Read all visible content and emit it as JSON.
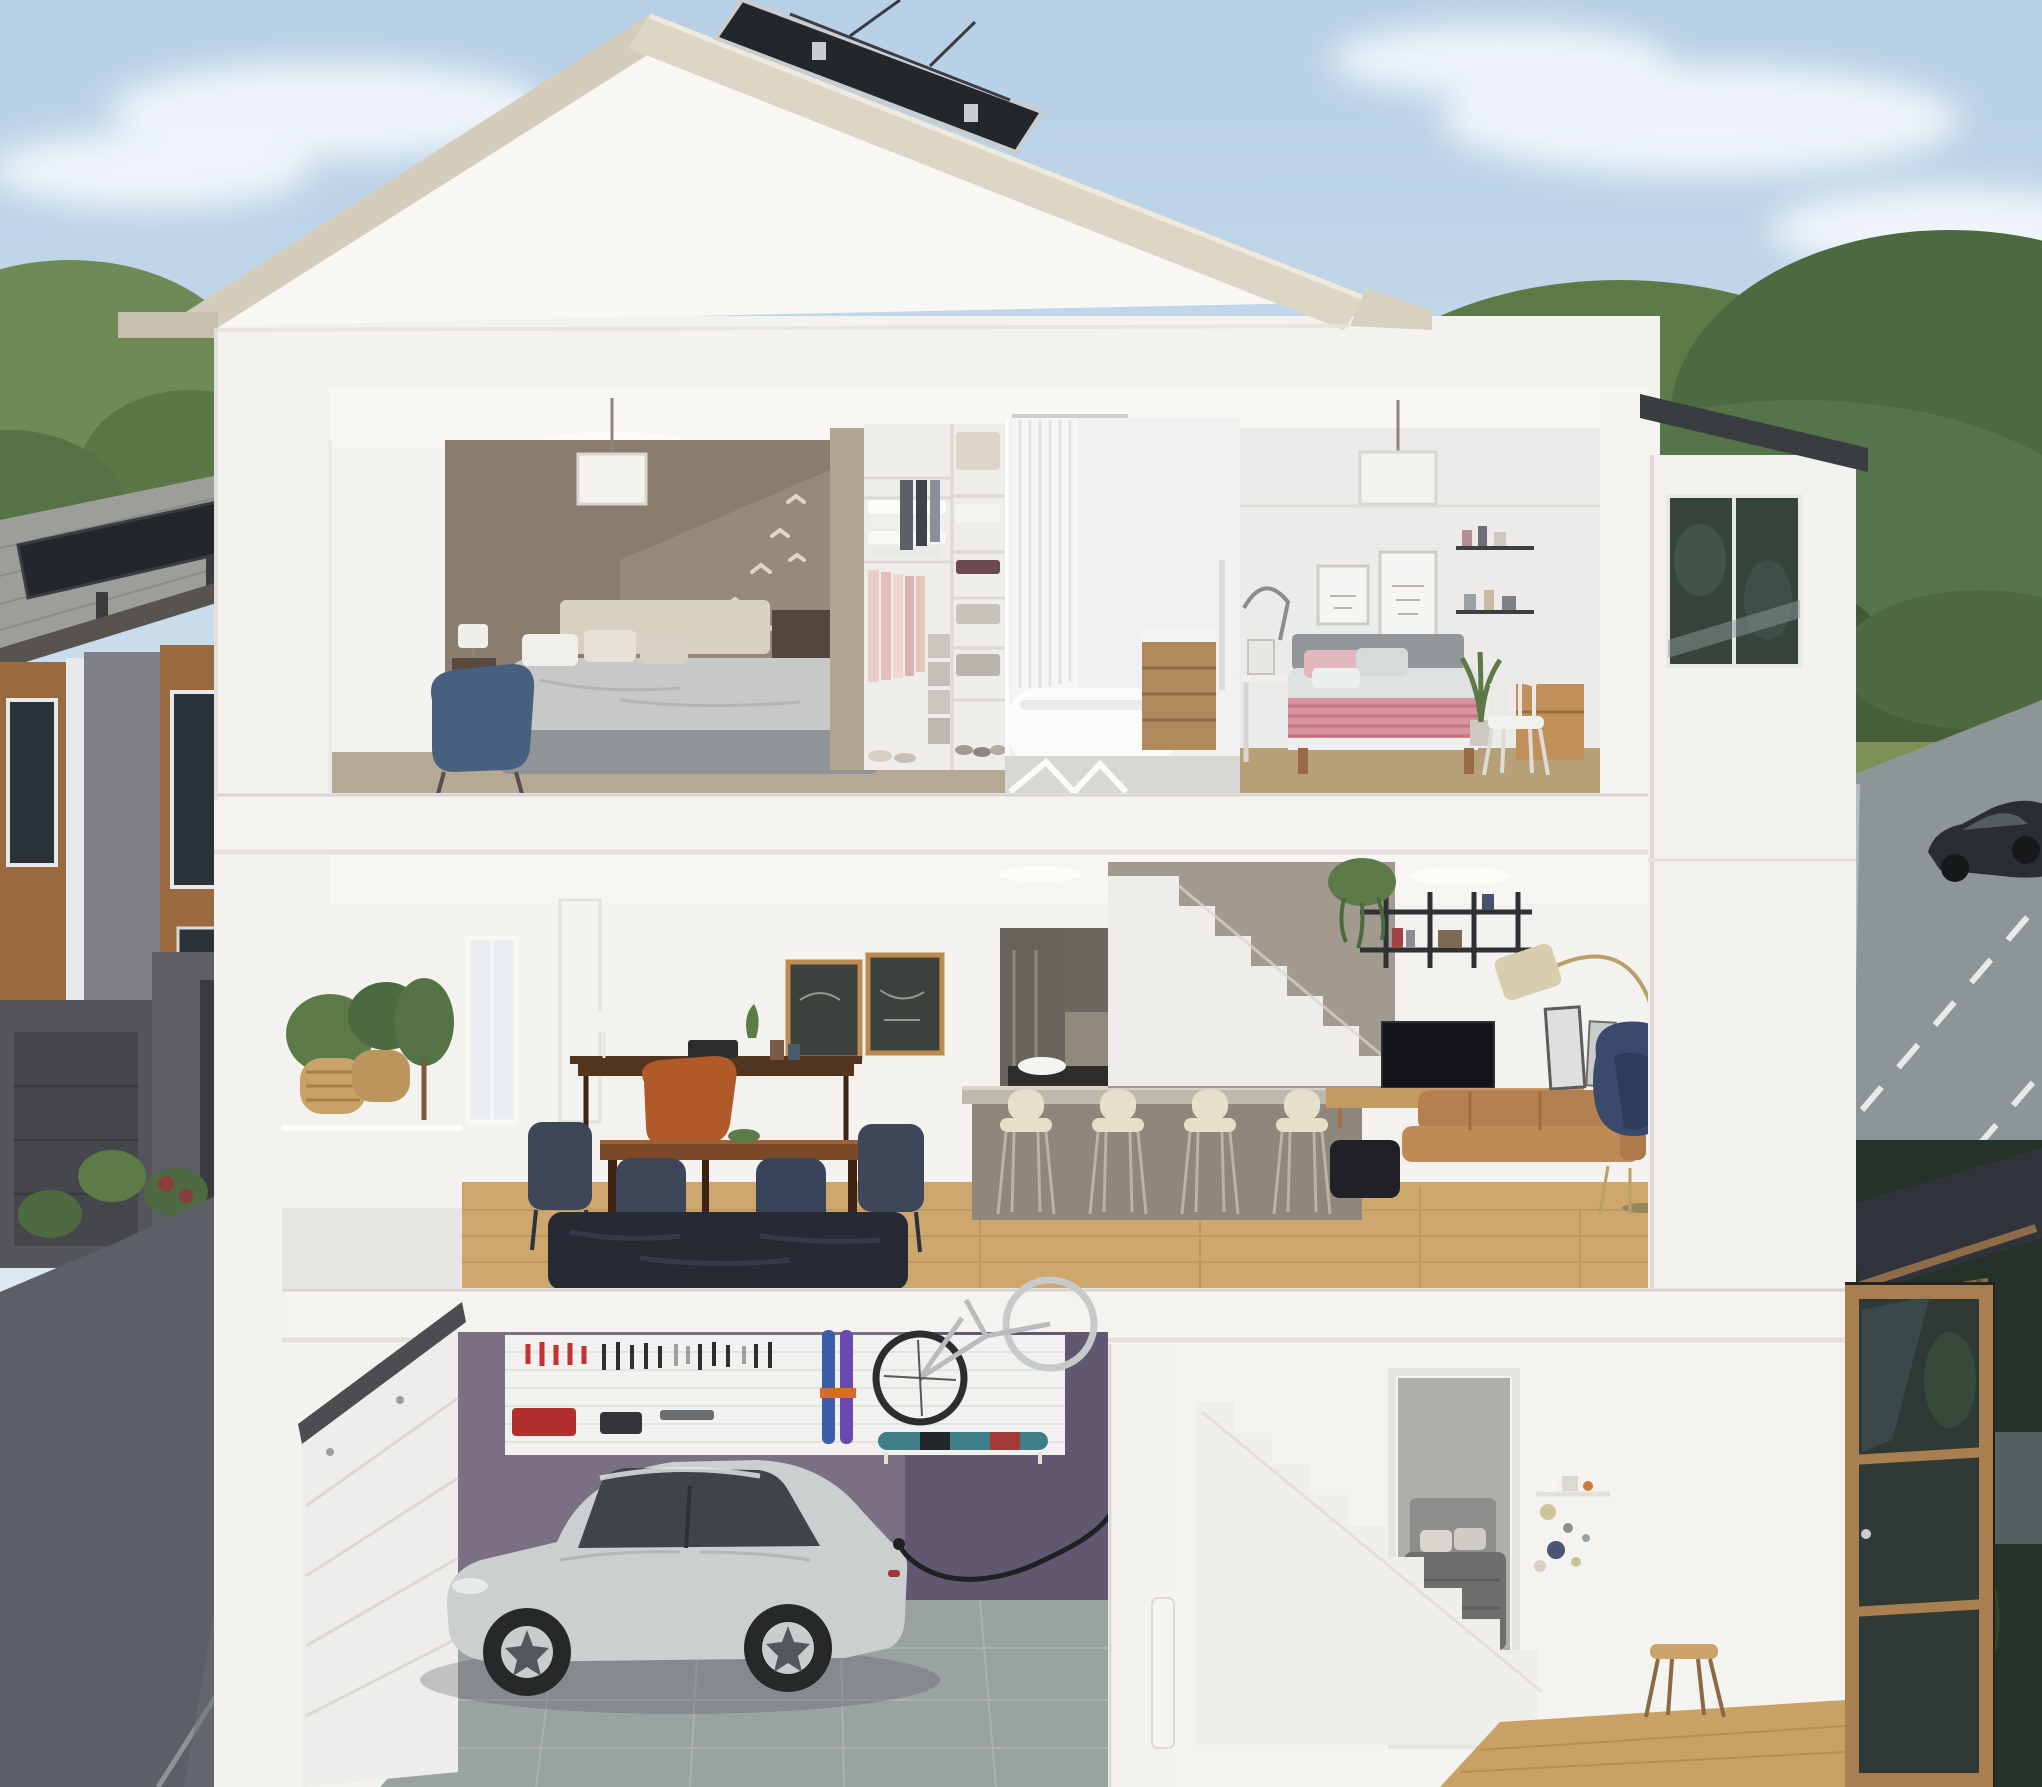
{
  "scene": {
    "type": "architectural-cutaway-rendering",
    "subject": "three-storey townhouse cross-section",
    "floors": [
      {
        "name": "upper-floor",
        "rooms": [
          "primary-bedroom",
          "walk-in-closet",
          "bathroom",
          "second-bedroom"
        ]
      },
      {
        "name": "main-floor",
        "rooms": [
          "balcony",
          "dining-area",
          "kitchen",
          "staircase",
          "living-room"
        ]
      },
      {
        "name": "ground-floor",
        "rooms": [
          "garage",
          "stairwell",
          "basement-bedroom",
          "entry-hall"
        ]
      }
    ],
    "garage_items": [
      "silver-electric-sedan",
      "ev-charging-cable",
      "tool-pegboard",
      "skis",
      "wall-mounted-bicycle",
      "snowboard-shelf",
      "sectional-garage-door"
    ],
    "roof_features": [
      "solar-panel",
      "beige-fascia"
    ],
    "surroundings": [
      "neighbouring-townhomes",
      "rear-lane-with-people",
      "street-with-passing-car",
      "trees-and-hedge",
      "pergola-over-entry"
    ]
  },
  "palette": {
    "sky_top": "#b7d0e6",
    "sky_bottom": "#e9f1f7",
    "cloud": "#ffffff",
    "roof_fascia": "#d5ccbb",
    "roof_soffit": "#c9bfae",
    "gable_wall": "#f8f7f4",
    "solar_panel": "#23262b",
    "solar_frame": "#c9cdd0",
    "wall_white": "#f3f2ef",
    "wall_shade": "#e8e6e1",
    "slab": "#f4f3f0",
    "slab_edge": "#d9d5cf",
    "accent_taupe": "#8b7d6e",
    "carpet": "#b5a894",
    "closet_panel": "#b2a692",
    "closet_bg": "#efedea",
    "hang_pink": "#e5c4be",
    "bath_bg": "#f0f1f1",
    "curtain": "#f6f6f4",
    "tub": "#fbfbfa",
    "vanity_wood": "#b08a5c",
    "bedroom2_bg": "#ecebe9",
    "bedroom2_floor": "#b79f78",
    "headboard2": "#94979a",
    "bedding_pink": "#d793a0",
    "bed_platform": "#8f9496",
    "duvet": "#c7c9c7",
    "headboard_cream": "#d9d0c1",
    "chair_blue": "#48607f",
    "wood_floor": "#cda76e",
    "wood_floor_dark": "#b68d57",
    "rug_navy": "#262a34",
    "chair_navy": "#3d4759",
    "table_wood": "#7a4a28",
    "console_wood": "#52351f",
    "chair_rust": "#b05a2a",
    "kitchen_cab": "#67625b",
    "kitchen_wood": "#875f3c",
    "backsplash": "#8f887d",
    "counter_dark": "#2e2d2b",
    "island_face": "#8d877c",
    "island_top": "#bdb8ac",
    "stool_cream": "#e6dfc9",
    "appliance_red": "#b3272e",
    "stair_taupe": "#a29a8e",
    "stair_white": "#efedea",
    "shelf_black": "#2f3134",
    "tv_black": "#141519",
    "console_oak": "#c59a62",
    "sofa_tan": "#b5804f",
    "egg_navy": "#3a4a6d",
    "lamp_shade": "#d9cdb0",
    "lamp_gold": "#b9a06a",
    "window_bright": "#eef0ef",
    "window_dark": "#36443c",
    "fascia_dark": "#3a3d40",
    "garage_purple": "#7b7083",
    "garage_purple_dark": "#5f5870",
    "garage_floor": "#9ba3a2",
    "tile_line": "#aeb5b4",
    "garage_door": "#efedeb",
    "door_rail": "#4b4d51",
    "pegboard": "#f2f1ef",
    "tool_red": "#c23333",
    "tool_dark": "#2c2e30",
    "ski_blue": "#3a5fa8",
    "ski_violet": "#6a4ab0",
    "bike_dark": "#2b2d2f",
    "bike_light": "#c6cacb",
    "board_teal": "#3f7f8a",
    "car_body": "#cbcfd0",
    "car_shade": "#a7adaf",
    "car_glass": "#3e4448",
    "wheel_dark": "#26282a",
    "rim": "#c9cdce",
    "cable": "#202124",
    "basement_wall": "#b0aeaa",
    "basement_duvet": "#6e6e6d",
    "basement_head": "#8e8e8c",
    "entry_wood": "#a97f50",
    "entry_glass": "#2f3a36",
    "landing_wood": "#c9a165",
    "dot_beige": "#cfc49a",
    "dot_navy": "#4b5575",
    "stool_tan": "#caa36b",
    "tree_green": "#5d7a49",
    "tree_mid": "#4c6a3f",
    "tree_dark": "#3a5334",
    "hedge": "#46603c",
    "evening_tree": "#243227",
    "grass": "#7f8f58",
    "road": "#8e9596",
    "road_edge": "#e8eae9",
    "street_car": "#2a2d31",
    "lane": "#5c6066",
    "lane_dark": "#4b4e55",
    "curb": "#9ba1a3",
    "n_roof": "#9d9d99",
    "n_brown": "#996a40",
    "n_grey": "#7e8085",
    "n_panel": "#cfd2d4",
    "n_dark": "#55565b",
    "n_darker": "#46474b",
    "n_window": "#2c3338",
    "n_trim": "#e8e9ea",
    "post_wood": "#9a7448",
    "person_dark": "#2e2a28",
    "person_light": "#8e8a84",
    "shrub_red": "#8a3d3d",
    "plant_green": "#5d7a49",
    "bird": "#ded5c6",
    "pendant": "#f3f2ef",
    "balcony_rail": "#f2f1ee",
    "wicker": "#c8a268",
    "pergola_dark": "#30343a",
    "pergola_wood": "#8f6c49"
  }
}
